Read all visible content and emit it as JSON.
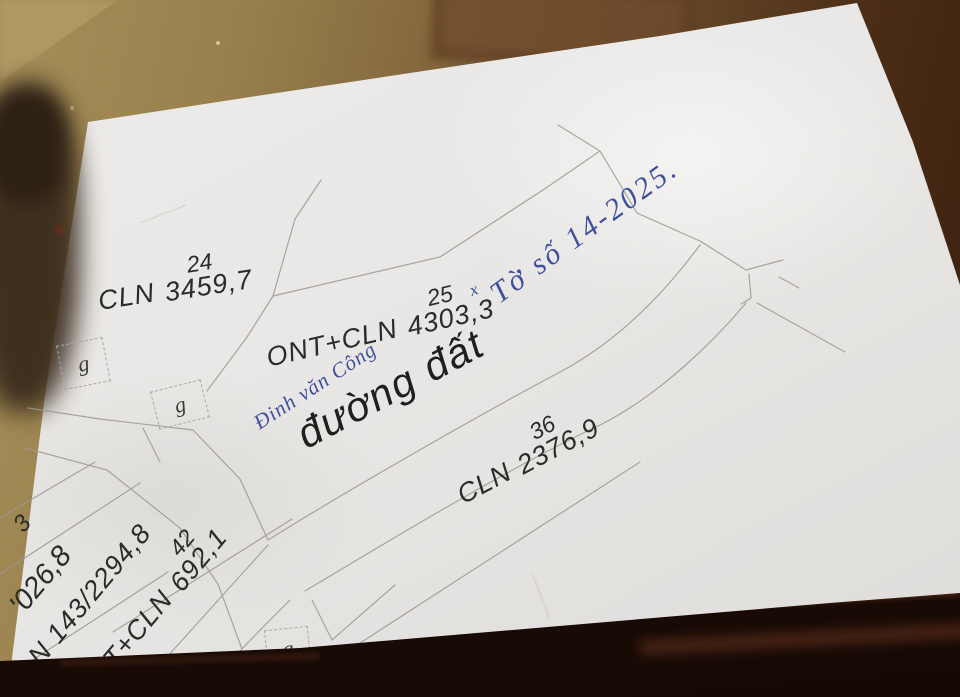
{
  "map": {
    "road_label": "đường đất",
    "parcels": {
      "p24": {
        "code": "CLN",
        "num": "24",
        "area": "3459,7"
      },
      "p25": {
        "code": "ONT+CLN",
        "num": "25",
        "area": "4303,3"
      },
      "p36": {
        "code": "CLN",
        "num": "36",
        "area": "2376,9"
      },
      "p42": {
        "code": "T+CLN",
        "num": "42",
        "area": "692,1"
      },
      "p143": {
        "text": "N 143/2294,8"
      },
      "edge_area": {
        "text": "'026,8"
      },
      "edge_digit": {
        "text": "3"
      }
    },
    "symbols": {
      "g1": "g",
      "g2": "g",
      "g3": "g"
    }
  },
  "handwriting": {
    "owner_name": "Đinh văn Công",
    "sheet_note": "Tờ số 14-2025.",
    "mark": "x",
    "ink_color": "#3f4f9e"
  },
  "colors": {
    "paper": "#e9e7e5",
    "map_line": "#9b9894",
    "label_text": "#2b2b29",
    "table_light": "#a68f59",
    "table_dark": "#371f0e",
    "table_edge": "#1d0c06"
  }
}
